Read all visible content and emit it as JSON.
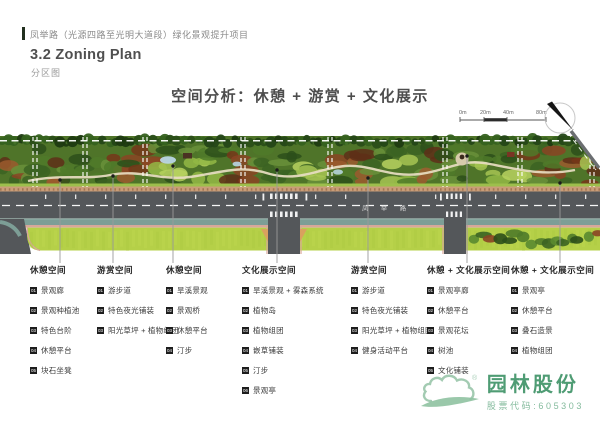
{
  "header": {
    "project_title": "凤举路（光源四路至光明大道段）绿化景观提升项目",
    "section_title": "3.2 Zoning Plan",
    "section_subtitle": "分区图"
  },
  "main_heading": "空间分析：休憩 + 游赏 + 文化展示",
  "map": {
    "scale_labels": [
      "0m",
      "20m",
      "40m",
      "80m"
    ],
    "north_label": "N",
    "road_name": "凤 举 路"
  },
  "legend": {
    "columns": [
      {
        "title": "休憩空间",
        "items": [
          {
            "num": "01",
            "label": "景观廊"
          },
          {
            "num": "02",
            "label": "景观种植池"
          },
          {
            "num": "03",
            "label": "特色台阶"
          },
          {
            "num": "04",
            "label": "休憩平台"
          },
          {
            "num": "05",
            "label": "块石坐凳"
          }
        ]
      },
      {
        "title": "游赏空间",
        "items": [
          {
            "num": "01",
            "label": "游步道"
          },
          {
            "num": "02",
            "label": "特色夜光铺装"
          },
          {
            "num": "03",
            "label": "阳光草坪 + 植物组团"
          }
        ]
      },
      {
        "title": "休憩空间",
        "items": [
          {
            "num": "01",
            "label": "旱溪景观"
          },
          {
            "num": "02",
            "label": "景观桥"
          },
          {
            "num": "03",
            "label": "休憩平台"
          },
          {
            "num": "04",
            "label": "汀步"
          }
        ]
      },
      {
        "title": "文化展示空间",
        "items": [
          {
            "num": "01",
            "label": "旱溪景观 + 雾森系统"
          },
          {
            "num": "02",
            "label": "植物岛"
          },
          {
            "num": "03",
            "label": "植物组团"
          },
          {
            "num": "04",
            "label": "嵌草铺装"
          },
          {
            "num": "05",
            "label": "汀步"
          },
          {
            "num": "06",
            "label": "景观亭"
          }
        ]
      },
      {
        "title": "游赏空间",
        "items": [
          {
            "num": "01",
            "label": "游步道"
          },
          {
            "num": "02",
            "label": "特色夜光铺装"
          },
          {
            "num": "03",
            "label": "阳光草坪 + 植物组团"
          },
          {
            "num": "04",
            "label": "健身活动平台"
          }
        ]
      },
      {
        "title": "休憩 + 文化展示空间",
        "items": [
          {
            "num": "01",
            "label": "景观亭廊"
          },
          {
            "num": "02",
            "label": "休憩平台"
          },
          {
            "num": "03",
            "label": "景观花坛"
          },
          {
            "num": "04",
            "label": "树池"
          },
          {
            "num": "05",
            "label": "文化铺装"
          }
        ]
      },
      {
        "title": "休憩 + 文化展示空间",
        "items": [
          {
            "num": "01",
            "label": "景观亭"
          },
          {
            "num": "02",
            "label": "休憩平台"
          },
          {
            "num": "03",
            "label": "叠石造景"
          },
          {
            "num": "04",
            "label": "植物组团"
          }
        ]
      }
    ]
  },
  "footer": {
    "company_name": "园林股份",
    "stock_code": "股票代码:605303",
    "registered_mark": "®"
  }
}
